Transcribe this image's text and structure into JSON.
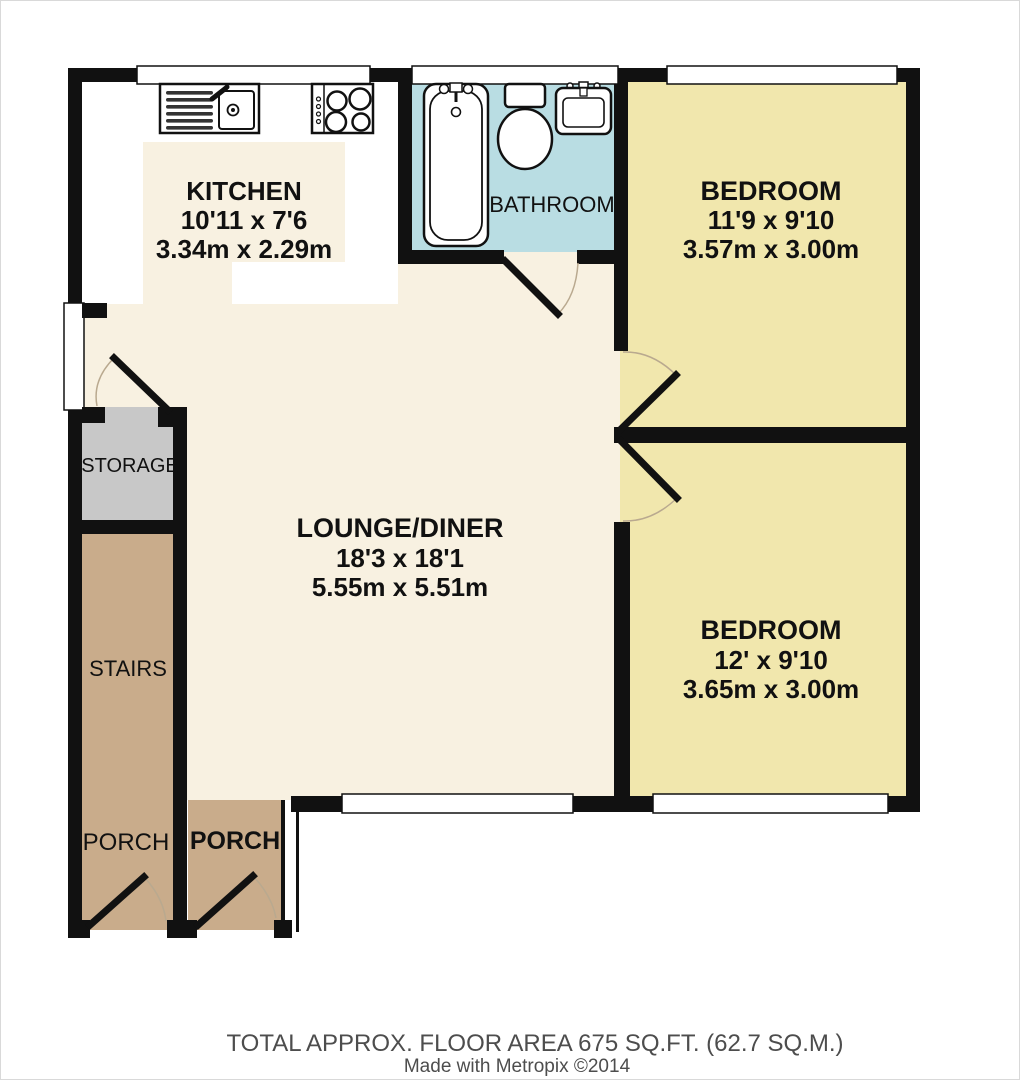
{
  "rooms": {
    "kitchen": {
      "name": "KITCHEN",
      "imperial": "10'11 x 7'6",
      "metric": "3.34m x 2.29m"
    },
    "bathroom": {
      "name": "BATHROOM"
    },
    "bedroom1": {
      "name": "BEDROOM",
      "imperial": "11'9 x 9'10",
      "metric": "3.57m x 3.00m"
    },
    "lounge": {
      "name": "LOUNGE/DINER",
      "imperial": "18'3 x 18'1",
      "metric": "5.55m x 5.51m"
    },
    "bedroom2": {
      "name": "BEDROOM",
      "imperial": "12' x 9'10",
      "metric": "3.65m x 3.00m"
    },
    "storage": {
      "name": "STORAGE"
    },
    "stairs": {
      "name": "STAIRS"
    },
    "porch_left": {
      "name": "PORCH"
    },
    "porch_right": {
      "name": "PORCH"
    }
  },
  "footer": {
    "area_line": "TOTAL APPROX. FLOOR AREA 675 SQ.FT. (62.7 SQ.M.)",
    "credit_line": "Made with Metropix ©2014"
  },
  "colors": {
    "wall": "#111111",
    "lounge_floor": "#f8f1e1",
    "bedroom_floor": "#f1e7ad",
    "bathroom_floor": "#b9dde3",
    "storage_floor": "#c8c8c8",
    "porch_floor": "#c9ac8b",
    "kitchen_floor": "#ffffff",
    "footer_text": "#4d4d4d"
  }
}
